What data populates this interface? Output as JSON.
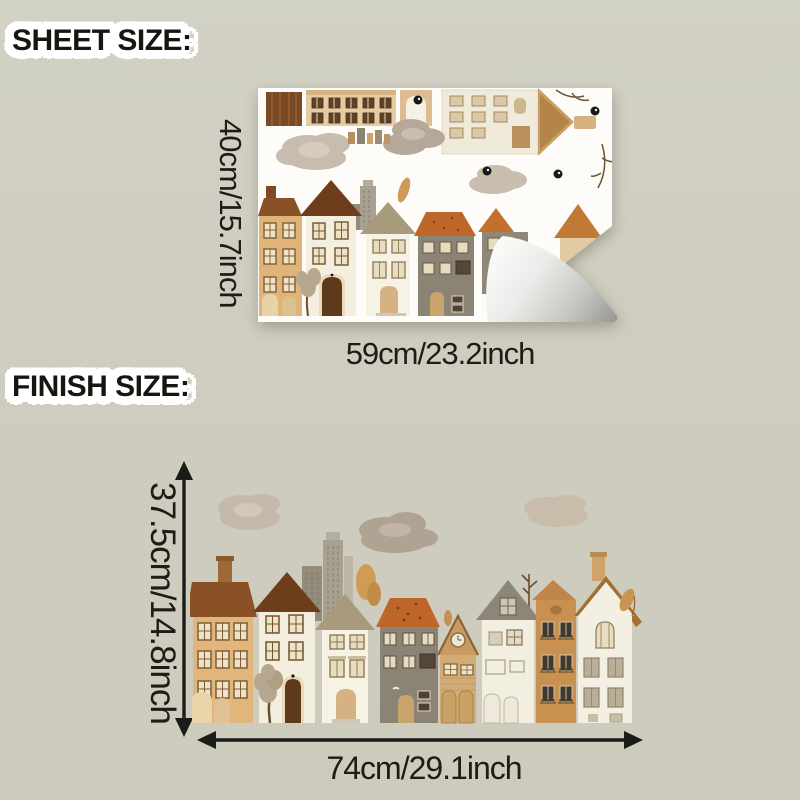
{
  "sheet_size_section": {
    "title": "SHEET SIZE:",
    "height_label": "40cm/15.7inch",
    "width_label": "59cm/23.2inch"
  },
  "finish_size_section": {
    "title": "FINISH SIZE:",
    "height_label": "37.5cm/14.8inch",
    "width_label": "74cm/29.1inch"
  },
  "colors": {
    "background": "#cfcdc0",
    "text": "#1d1c17",
    "label_halo": "#ffffff",
    "sheet_paper": "#fdfcf8",
    "peel_backside": "#9a9a96",
    "house_tan": "#e2b67b",
    "house_cream": "#f3eedd",
    "house_gray": "#8b8474",
    "roof_dark_brown": "#6e3e1c",
    "roof_orange": "#bf662a",
    "cloud_taupe": "#b5a898",
    "arrow_black": "#1b1b18"
  }
}
